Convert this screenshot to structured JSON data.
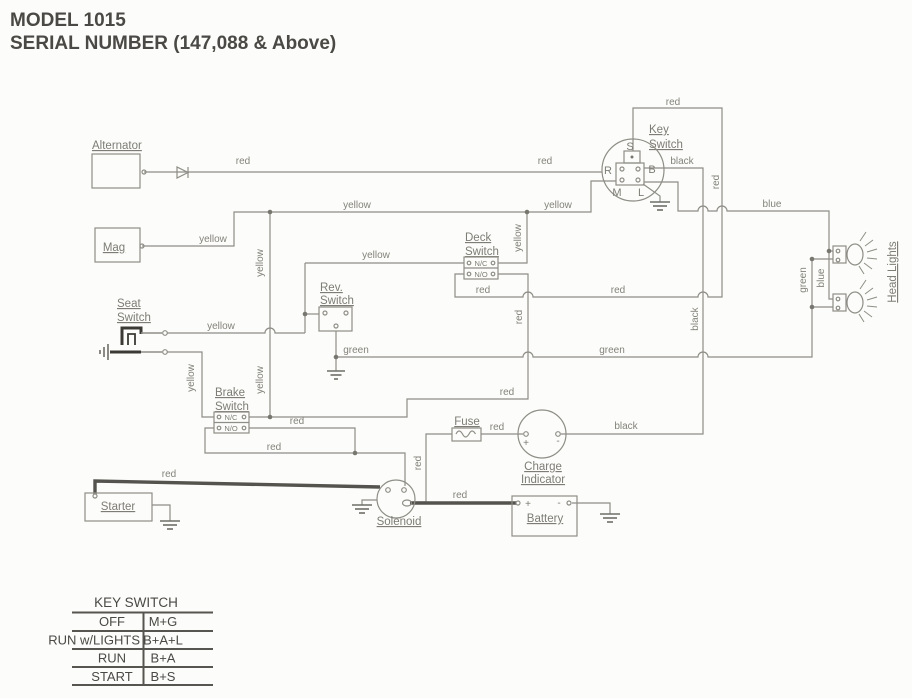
{
  "title": {
    "line1": "MODEL 1015",
    "line2": "SERIAL NUMBER (147,088 & Above)"
  },
  "labels": {
    "alternator": "Alternator",
    "mag": "Mag",
    "seat1": "Seat",
    "seat2": "Switch",
    "rev1": "Rev.",
    "rev2": "Switch",
    "deck1": "Deck",
    "deck2": "Switch",
    "brake1": "Brake",
    "brake2": "Switch",
    "key1": "Key",
    "key2": "Switch",
    "fuse": "Fuse",
    "charge1": "Charge",
    "charge2": "Indicator",
    "starter": "Starter",
    "solenoid": "Solenoid",
    "battery": "Battery",
    "headlights": "Head Lights",
    "nc": "N/C",
    "no": "N/O",
    "term_r": "R",
    "term_s": "S",
    "term_b": "B",
    "term_m": "M",
    "term_l": "L",
    "plus": "+",
    "minus": "-"
  },
  "wire_colors": {
    "red": "red",
    "yellow": "yellow",
    "green": "green",
    "blue": "blue",
    "black": "black"
  },
  "key_switch_table": {
    "title": "KEY SWITCH",
    "rows": [
      {
        "position": "OFF",
        "circuit": "M+G"
      },
      {
        "position": "RUN w/LIGHTS",
        "circuit": "B+A+L"
      },
      {
        "position": "RUN",
        "circuit": "B+A"
      },
      {
        "position": "START",
        "circuit": "B+S"
      }
    ]
  }
}
